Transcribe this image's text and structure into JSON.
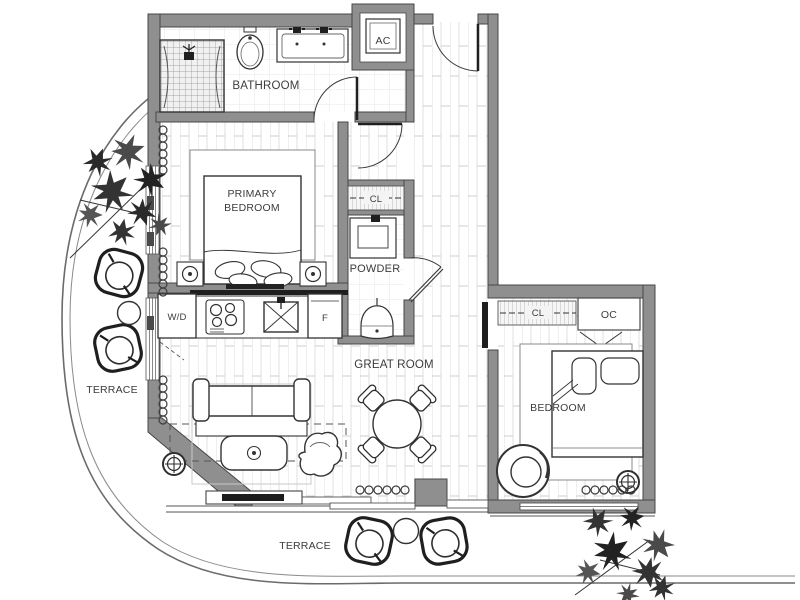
{
  "plan": {
    "labels": {
      "bathroom": "BATHROOM",
      "ac_closet": "AC",
      "primary_bedroom_line1": "PRIMARY",
      "primary_bedroom_line2": "BEDROOM",
      "closet_primary": "CL",
      "powder": "POWDER",
      "washer_dryer": "W/D",
      "fridge": "F",
      "great_room": "GREAT ROOM",
      "terrace_left": "TERRACE",
      "terrace_bottom": "TERRACE",
      "bedroom": "BEDROOM",
      "closet_bedroom": "CL",
      "oc_closet": "OC"
    },
    "colors": {
      "wall_fill": "#8f8f8f",
      "wall_edge": "#474747",
      "line_dark": "#2e2e2e",
      "floor_line": "#d9d9d9",
      "label_text": "#3c3c3c",
      "background": "#ffffff"
    }
  }
}
